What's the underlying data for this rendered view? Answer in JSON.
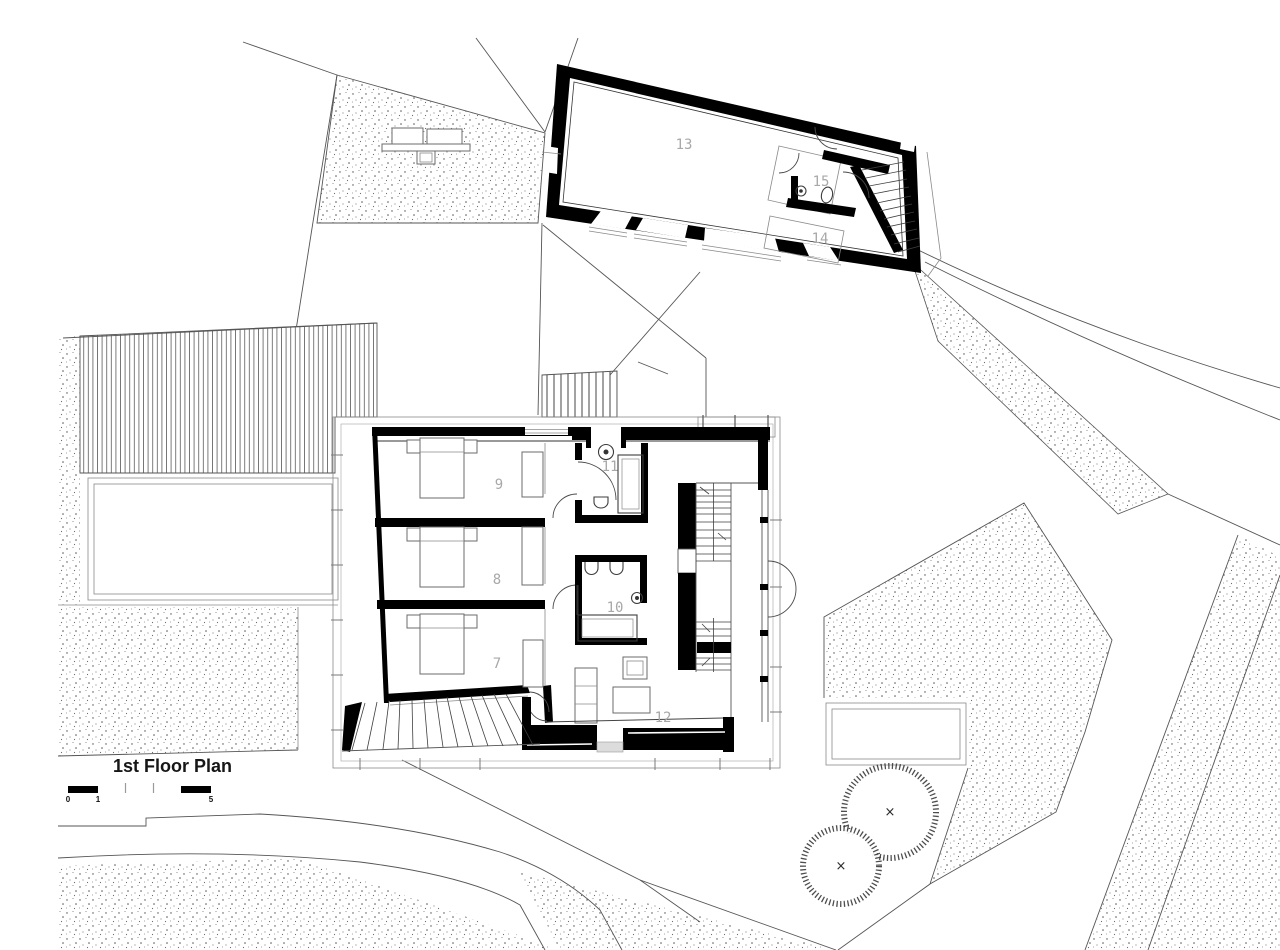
{
  "drawing": {
    "kind": "architectural site / floor plan",
    "paper_color": "#ffffff"
  },
  "title_block": {
    "title": "1st Floor Plan"
  },
  "scale_bar": {
    "label_start": "0",
    "label_one": "1",
    "label_five": "5"
  },
  "room_labels": {
    "7": "7",
    "8": "8",
    "9": "9",
    "10": "10",
    "11": "11",
    "12": "12",
    "13": "13",
    "14": "14",
    "15": "15"
  },
  "tree_markers": {
    "tree_1": "×",
    "tree_2": "×"
  },
  "colors": {
    "wall_ink": "#000000",
    "site_line": "#555555",
    "terrace_line": "#8a8a8a",
    "room_label": "#a8a8a8",
    "title_ink": "#161616",
    "paper": "#ffffff"
  }
}
